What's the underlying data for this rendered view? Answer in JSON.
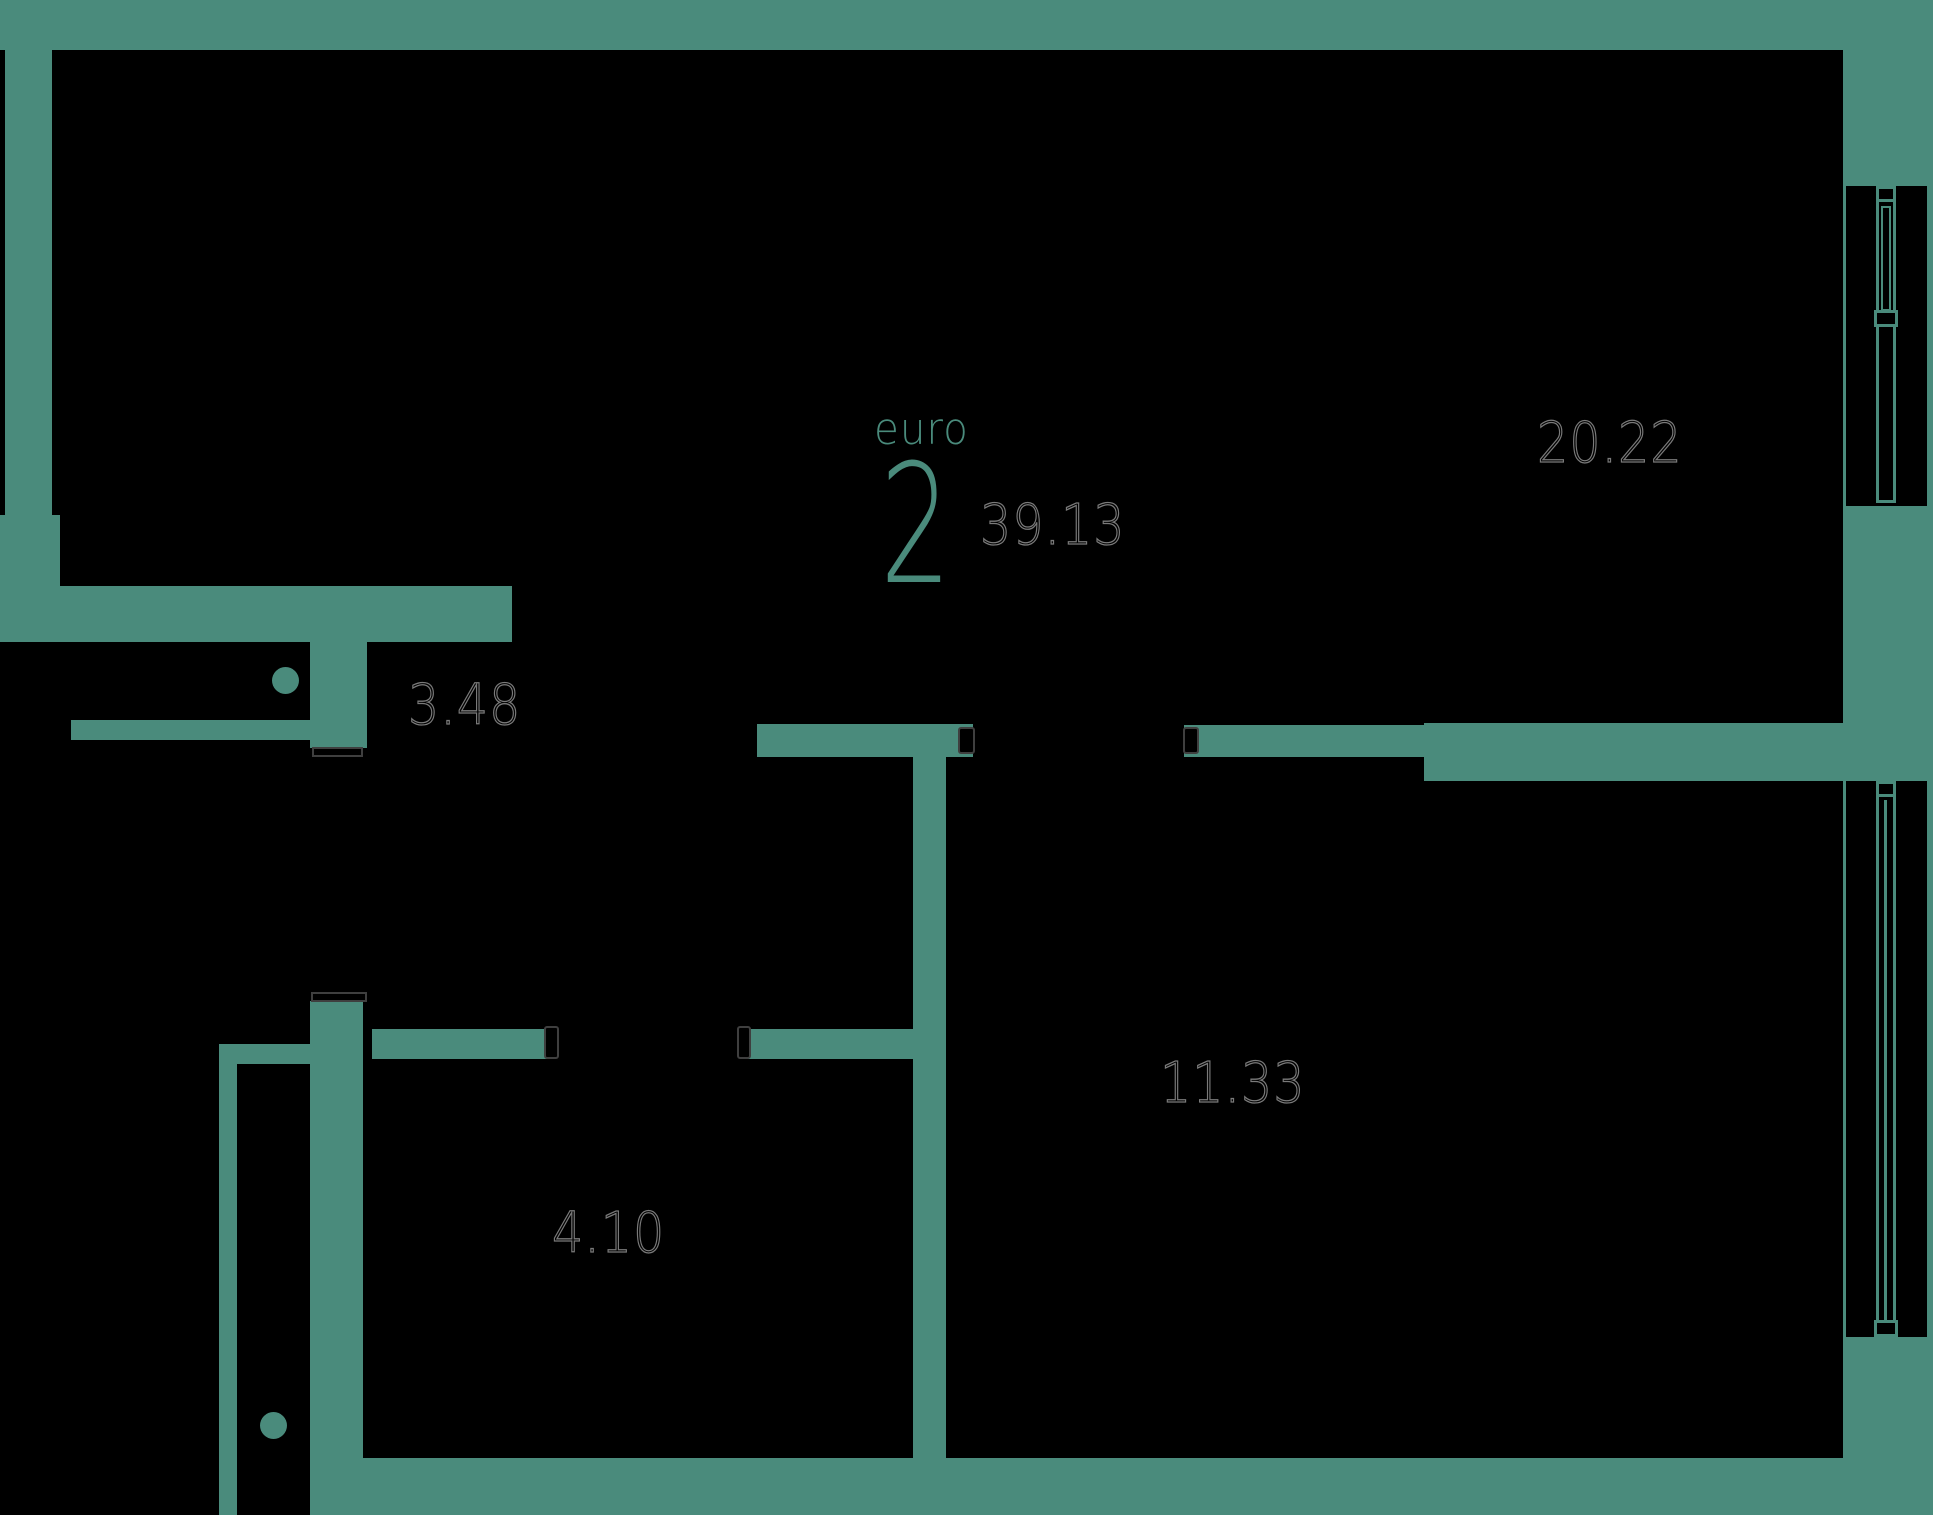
{
  "plan": {
    "type_label": "euro",
    "room_count": "2",
    "total_area": "39.13",
    "room_areas": [
      "20.22",
      "3.48",
      "11.33",
      "4.10"
    ],
    "colors": {
      "wall": "#4a8b7c",
      "background": "#000000",
      "area_text": "#7a7a7a"
    }
  }
}
